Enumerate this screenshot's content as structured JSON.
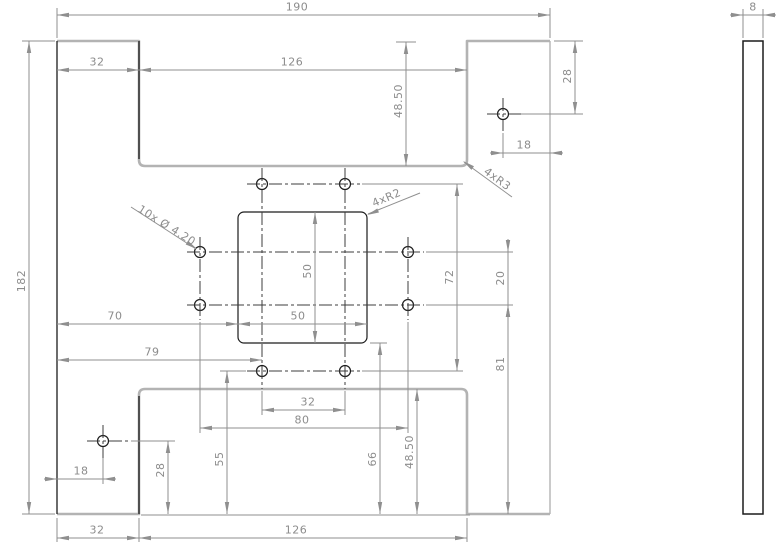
{
  "drawing": {
    "type": "2D engineering drawing, plate part, front and side views",
    "dimensions": {
      "overall_width": "190",
      "overall_height": "182",
      "thickness": "8",
      "top_tab_width": "32",
      "top_notch_width": "126",
      "top_notch_depth": "48.50",
      "top_hole_offset_right": "18",
      "top_hole_offset_top": "28",
      "pocket_width": "50",
      "pocket_height": "50",
      "pocket_offset_left": "70",
      "pocket_offset_bottom": "66",
      "hole_column_offset_left": "79",
      "hole_rows_spacing": "72",
      "side_holes_spacing": "20",
      "side_hole_offset_bottom": "81",
      "hole_pair_spacing": "32",
      "hole_columns_spacing": "80",
      "bottom_row_offset_bottom": "55",
      "bottom_notch_depth": "48.50",
      "bottom_hole_offset_left": "18",
      "bottom_hole_offset_bottom": "28",
      "bottom_tab_width": "32",
      "bottom_notch_width": "126"
    },
    "annotations": {
      "holes": "10x Ø 4.20",
      "outer_fillets": "4xR3",
      "pocket_fillets": "4xR2"
    }
  }
}
